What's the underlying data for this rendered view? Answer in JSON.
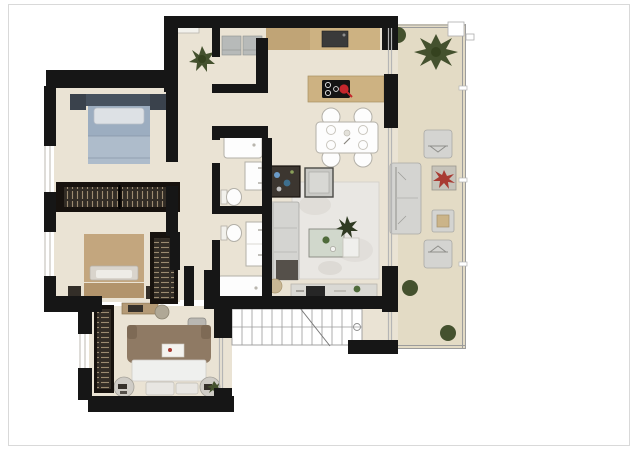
{
  "document": {
    "kind": "rendered architectural floor plan",
    "view": "top-down 2D render, no text labels",
    "page_background": "#ffffff",
    "frame_border_color": "#d9d9d9"
  },
  "colors": {
    "wall": "#161616",
    "floor": "#eae3d4",
    "terrace_floor": "#e3dbc5",
    "wood": "#cdb282",
    "wood_dark": "#c0a476",
    "appliance_gray": "#b7bab9",
    "fixture_white": "#fdfdfd",
    "fixture_border": "#b3b0a8",
    "glass_line": "#b5b5b5",
    "stairs_line": "#9a9a9a",
    "sofa_gray": "#d4d4d1",
    "rug": "#e9e7e3",
    "bed_blue": "#9cadc0",
    "bed_blue_dark": "#47525f",
    "bed_tan": "#c3a67e",
    "bed_brown": "#8f7a64",
    "wardrobe_dark": "#322c25",
    "wardrobe_stripe": "#9b8a70",
    "plant_green": "#44512e",
    "plant_red": "#a83a32",
    "cooktop_black": "#141414",
    "pot_red": "#c4262c",
    "tv_black": "#262626"
  },
  "scene": {
    "rooms": [
      {
        "id": "entry-hall",
        "items": [
          "console-shelf",
          "potted-plant"
        ]
      },
      {
        "id": "laundry-closet",
        "items": [
          "washer",
          "dryer"
        ]
      },
      {
        "id": "kitchen",
        "items": [
          "counter-run",
          "sink",
          "island",
          "cooktop",
          "red-pot"
        ]
      },
      {
        "id": "dining-area",
        "items": [
          "table",
          "chair",
          "chair",
          "chair",
          "chair",
          "place-settings"
        ]
      },
      {
        "id": "living-room",
        "items": [
          "bar-cabinet",
          "lounge-chair",
          "sofa",
          "marble-rug",
          "coffee-table",
          "plant",
          "side-table",
          "pouf",
          "tv-console",
          "tv"
        ]
      },
      {
        "id": "bedroom-1",
        "items": [
          "double-bed-blue",
          "nightstand",
          "nightstand",
          "wardrobe"
        ]
      },
      {
        "id": "bedroom-2",
        "items": [
          "double-bed-tan",
          "nightstand",
          "nightstand",
          "wardrobe",
          "wardrobe"
        ]
      },
      {
        "id": "bedroom-3",
        "items": [
          "double-bed-brown",
          "foot-bench",
          "round-side-table",
          "round-side-table",
          "wardrobe",
          "vanity-desk",
          "stool"
        ]
      },
      {
        "id": "bathroom-1",
        "items": [
          "bathtub",
          "washbasin",
          "toilet"
        ]
      },
      {
        "id": "bathroom-2",
        "items": [
          "toilet",
          "double-washbasin",
          "bathtub"
        ]
      },
      {
        "id": "stairs",
        "items": [
          "steps",
          "break-line",
          "handrail"
        ]
      },
      {
        "id": "terrace",
        "items": [
          "glass-railing",
          "palm-plant",
          "bush",
          "bush",
          "bush",
          "outdoor-armchair",
          "outdoor-armchair",
          "outdoor-sofa",
          "planter-red",
          "outdoor-table"
        ]
      }
    ]
  }
}
